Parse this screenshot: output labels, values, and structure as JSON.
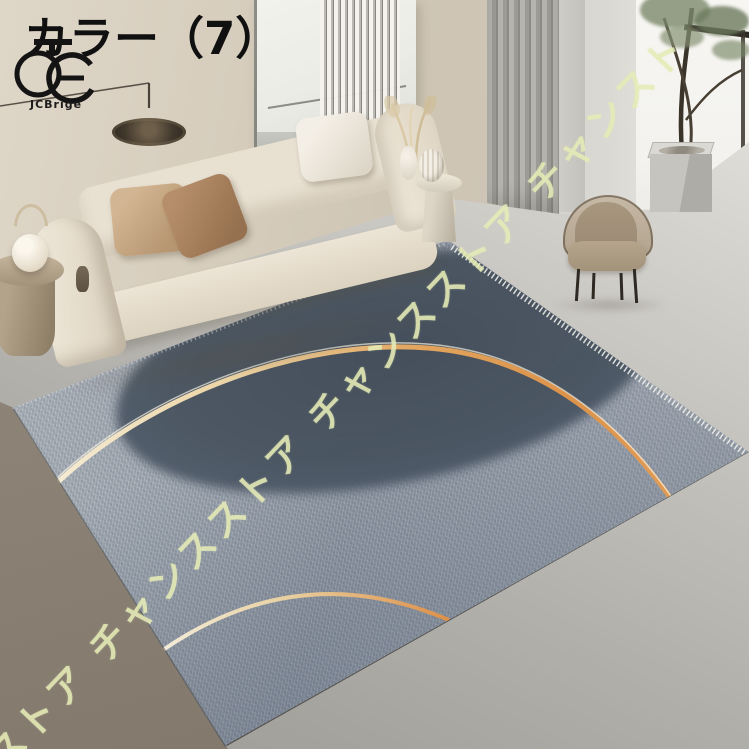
{
  "header": {
    "color_label": "カラー（7）"
  },
  "brand": {
    "logo_icon": "interlocked-rings-monogram",
    "name": "JCBrige"
  },
  "watermark": {
    "phrase": "チャンスストア",
    "display_line": "ストア チャンスストア チャンスストア チャンスト",
    "color": "#e5ebb6"
  },
  "scene": {
    "items": {
      "sofa": "cream-modular-sofa",
      "pillows": [
        "tan",
        "brown",
        "white"
      ],
      "side_table_left": "round-wood-side-table",
      "sphere_lamp": "white-ball-lantern",
      "side_table_right": "stone-pedestal-table",
      "vases": "white-ceramic-vases",
      "pampas": "dried-pampas-stems",
      "chair": "taupe-accent-chair",
      "floor_lamp": "black-disc-arc-lamp",
      "wall_art": "abstract-canvas",
      "wall_hanging": "fringe-macrame",
      "curtain": "gray-pleated-curtain",
      "plant": "indoor-tree",
      "planter": "concrete-cube-planter",
      "rug": "gray-circle-gold-arc-rug"
    },
    "colors": {
      "wall_beige": "#d6cdbd",
      "wall_gray": "#dbd9d3",
      "window_white": "#f6f5f1",
      "floor_concrete": "#b2b0ab",
      "floor_brown": "#8a8074",
      "rug_base": "#98a0aa",
      "rug_dark_circle": "#4c5763",
      "arc_gold": "#df9a52",
      "arc_cream": "#f2e7cd",
      "sofa": "#ece5d7",
      "pillow_tan": "#c7a987",
      "pillow_brown": "#a5815f",
      "chair": "#a8997f",
      "plant_green": "#7c8a6b"
    }
  }
}
